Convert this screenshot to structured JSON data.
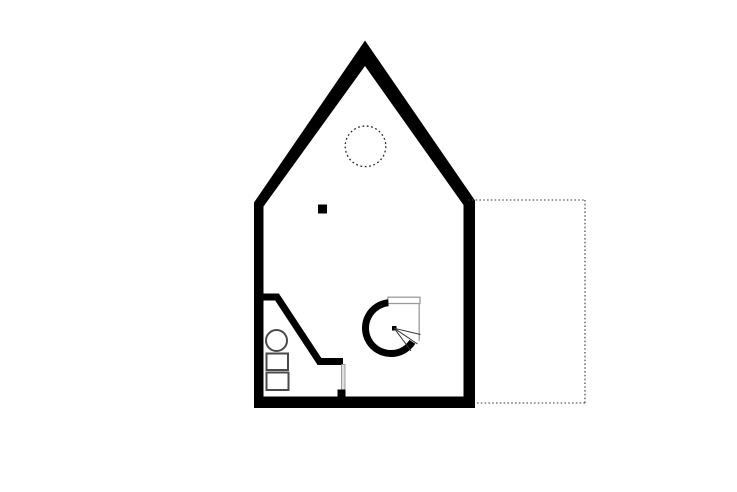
{
  "canvas": {
    "width": 737,
    "height": 492,
    "background": "#ffffff"
  },
  "palette": {
    "wall": "#000000",
    "fixture_stroke": "#4a4a4a",
    "light_gray": "#9a9a9a",
    "tread_stroke": "#333333",
    "door_leaf_fill": "#e0e0e0",
    "door_leaf_stroke": "#888888",
    "dashed_dark": "#2a2a2a",
    "terrace_stroke": "#3a3a3a",
    "background": "#ffffff"
  },
  "floorplan": {
    "exterior_wall": {
      "outer": [
        [
          254,
          408
        ],
        [
          254,
          202.5
        ],
        [
          365,
          40.5
        ],
        [
          475,
          200.5
        ],
        [
          475,
          408
        ]
      ],
      "inner": [
        [
          263.5,
          396.5
        ],
        [
          263.5,
          206.5
        ],
        [
          365,
          66
        ],
        [
          463.5,
          205
        ],
        [
          463.5,
          396.5
        ]
      ]
    },
    "bathroom": {
      "partition_points": [
        [
          262,
          297
        ],
        [
          277,
          297
        ],
        [
          319.5,
          361.5
        ],
        [
          343,
          361.5
        ]
      ],
      "partition_width": 7,
      "door_leaf": {
        "x": 341.5,
        "y": 364.5,
        "w": 3.5,
        "h": 25.5
      },
      "door_stub": {
        "x": 337.5,
        "y": 389.5,
        "w": 8,
        "h": 7.5
      },
      "sink_circle": {
        "cx": 276.5,
        "cy": 340.5,
        "r": 10.5
      },
      "fixture_rect_1": {
        "x": 266.5,
        "y": 353.5,
        "w": 21.5,
        "h": 16.5
      },
      "fixture_rect_2": {
        "x": 266.5,
        "y": 372.5,
        "w": 22,
        "h": 17.5
      },
      "fixture_stroke_width": 2
    },
    "spiral_stair": {
      "ring": {
        "cx": 391,
        "cy": 328,
        "r": 25.5,
        "stroke_width": 7,
        "start": [
          388.3,
          302.7
        ],
        "end": [
          412.4,
          341.9
        ],
        "large_arc": 1,
        "sweep": 0
      },
      "landing_rect": {
        "x": 388,
        "y": 297.2,
        "w": 32,
        "h": 6.3
      },
      "side_line": [
        [
          419.2,
          303.5
        ],
        [
          419.2,
          341
        ]
      ],
      "newel_dot": {
        "x": 392,
        "y": 326,
        "size": 4.5
      },
      "treads": [
        [
          [
            394.3,
            328.3
          ],
          [
            420.5,
            334.5
          ]
        ],
        [
          [
            394.3,
            328.3
          ],
          [
            417.5,
            344.0
          ]
        ],
        [
          [
            394.3,
            328.3
          ],
          [
            411.0,
            351.0
          ]
        ]
      ]
    },
    "skylight_circle": {
      "cx": 365.5,
      "cy": 146.3,
      "r": 20.3,
      "dash": "1.8 2.6"
    },
    "column": {
      "x": 318,
      "y": 204.5,
      "size": 9
    },
    "terrace": {
      "dash": "1.6 2.2",
      "lines": [
        [
          [
            468,
            200
          ],
          [
            585,
            200
          ]
        ],
        [
          [
            585,
            200
          ],
          [
            585,
            403
          ]
        ],
        [
          [
            585,
            403
          ],
          [
            475,
            403
          ]
        ]
      ]
    }
  }
}
